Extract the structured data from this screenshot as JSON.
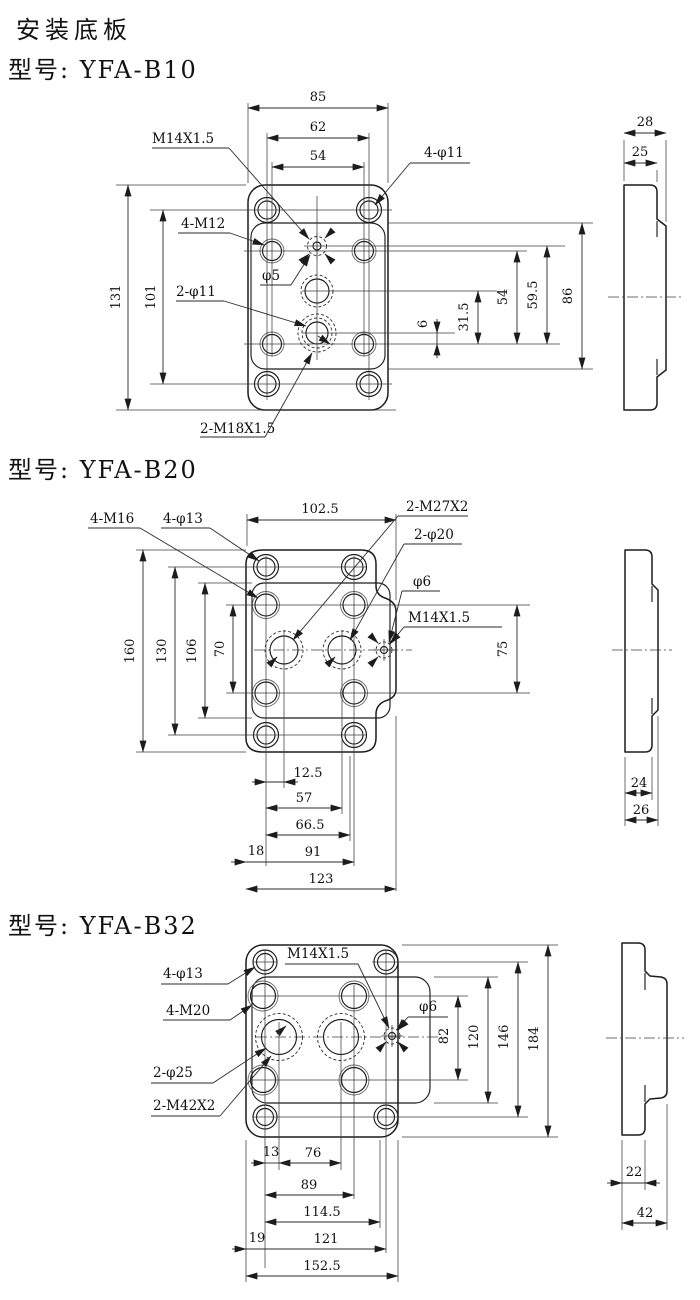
{
  "page": {
    "title": "安装底板"
  },
  "b10": {
    "model": "型号: YFA-B10",
    "front": {
      "top1": "85",
      "top2": "62",
      "top3": "54",
      "left1": "131",
      "left2": "101",
      "right1": "6",
      "right2": "31.5",
      "right3": "54",
      "right4": "59.5",
      "right5": "86",
      "labels": {
        "m14": "M14X1.5",
        "holes4": "4-φ11",
        "m12": "4-M12",
        "p5": "φ5",
        "p11": "2-φ11",
        "m18": "2-M18X1.5"
      }
    },
    "side": {
      "d1": "28",
      "d2": "25"
    }
  },
  "b20": {
    "model": "型号: YFA-B20",
    "front": {
      "top1": "102.5",
      "left1": "160",
      "left2": "130",
      "left3": "106",
      "left4": "70",
      "right1": "75",
      "bot1": "12.5",
      "bot2": "57",
      "bot3": "66.5",
      "bot4": "18",
      "bot5": "91",
      "bot6": "123",
      "labels": {
        "m16": "4-M16",
        "holes4": "4-φ13",
        "m27": "2-M27X2",
        "p20": "2-φ20",
        "p6": "φ6",
        "m14": "M14X1.5"
      }
    },
    "side": {
      "d1": "24",
      "d2": "26"
    }
  },
  "b32": {
    "model": "型号: YFA-B32",
    "front": {
      "right1": "82",
      "right2": "120",
      "right3": "146",
      "right4": "184",
      "bot1": "13",
      "bot2": "76",
      "bot3": "89",
      "bot4": "114.5",
      "bot5": "19",
      "bot6": "121",
      "bot7": "152.5",
      "labels": {
        "m14": "M14X1.5",
        "holes4": "4-φ13",
        "m20": "4-M20",
        "p25": "2-φ25",
        "m42": "2-M42X2",
        "p6": "φ6"
      }
    },
    "side": {
      "d1": "22",
      "d2": "42"
    }
  }
}
